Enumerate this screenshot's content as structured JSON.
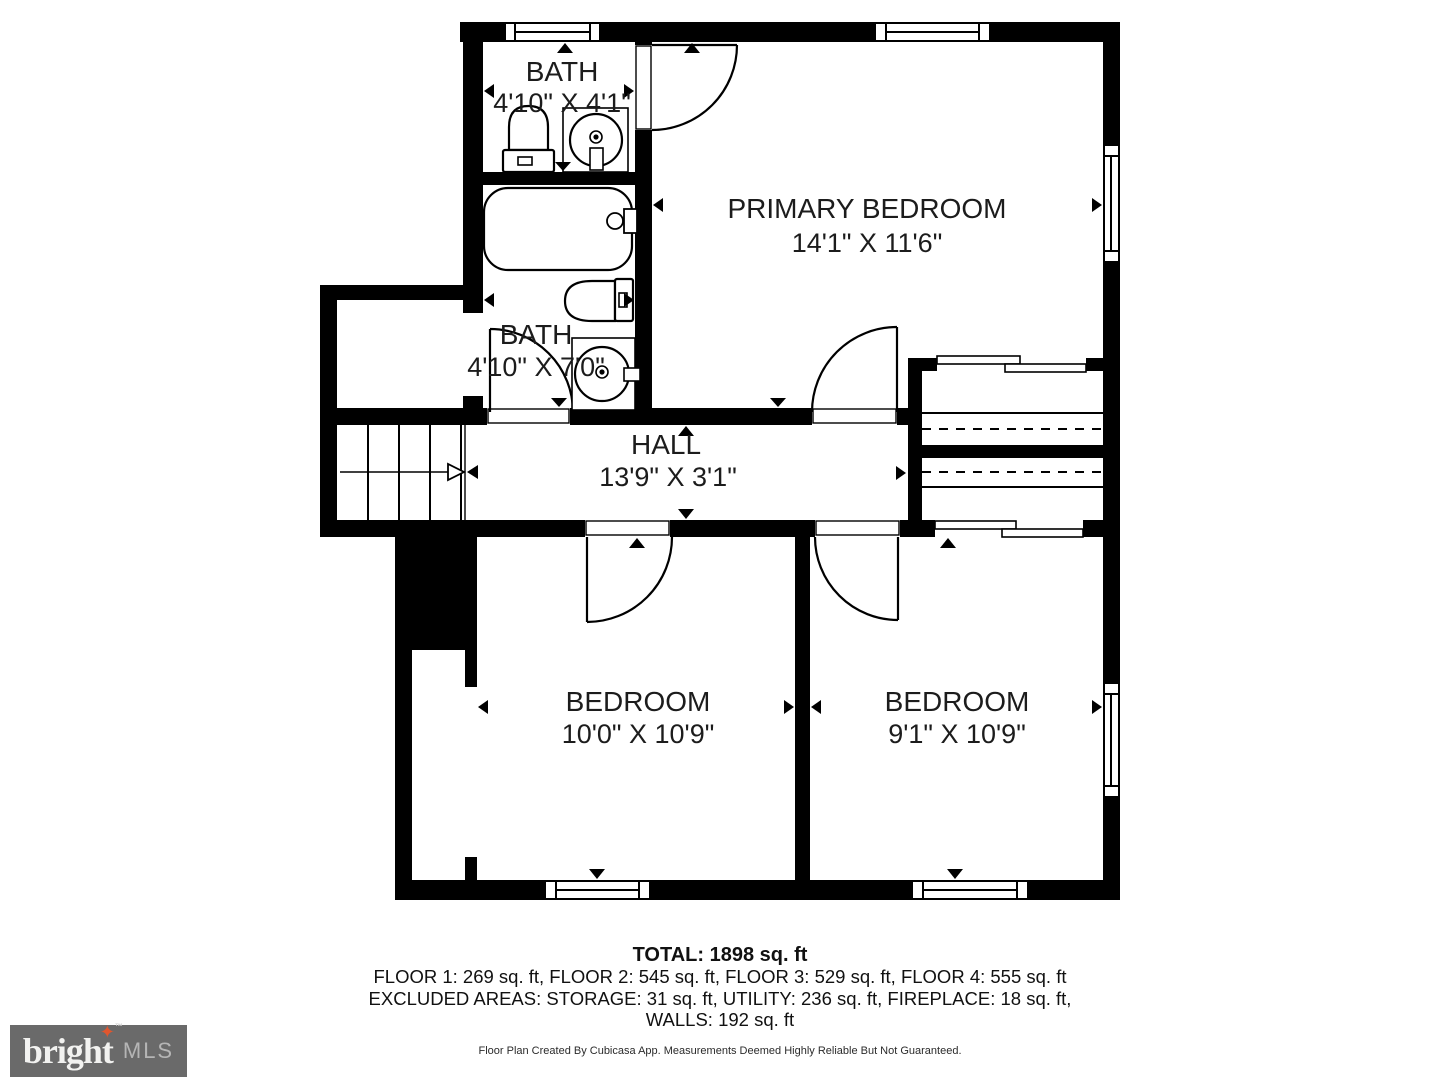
{
  "rooms": [
    {
      "id": "bath-top",
      "name": "BATH",
      "dims": "4'10\" X 4'1\""
    },
    {
      "id": "primary-bedroom",
      "name": "PRIMARY BEDROOM",
      "dims": "14'1\" X 11'6\""
    },
    {
      "id": "bath-middle",
      "name": "BATH",
      "dims": "4'10\" X 7'0\""
    },
    {
      "id": "hall",
      "name": "HALL",
      "dims": "13'9\" X 3'1\""
    },
    {
      "id": "bedroom-left",
      "name": "BEDROOM",
      "dims": "10'0\" X 10'9\""
    },
    {
      "id": "bedroom-right",
      "name": "BEDROOM",
      "dims": "9'1\" X 10'9\""
    }
  ],
  "summary": {
    "total": "TOTAL: 1898 sq. ft",
    "floors": "FLOOR 1: 269 sq. ft, FLOOR 2: 545 sq. ft, FLOOR 3: 529 sq. ft, FLOOR 4: 555 sq. ft",
    "excluded": "EXCLUDED AREAS: STORAGE: 31 sq. ft, UTILITY: 236 sq. ft, FIREPLACE: 18 sq. ft,",
    "walls": "WALLS: 192 sq. ft"
  },
  "disclaimer": "Floor Plan Created By Cubicasa App. Measurements Deemed Highly Reliable But Not Guaranteed.",
  "logo": {
    "brand": "bright",
    "suffix": "MLS",
    "tm": "™",
    "star": "✦",
    "accent_color": "#e0562e",
    "bg_color": "#6a6a6a"
  },
  "colors": {
    "wall": "#000000",
    "background": "#ffffff",
    "text": "#1c1c1c"
  }
}
